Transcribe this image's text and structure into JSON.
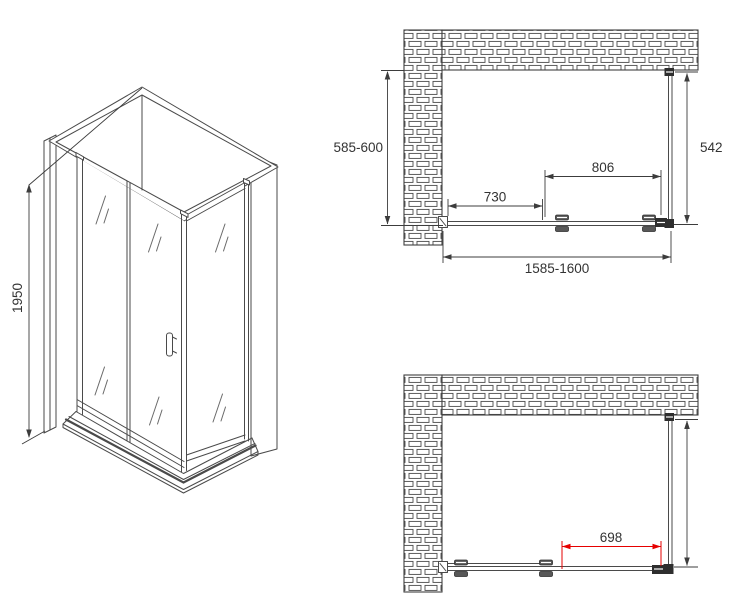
{
  "drawing": {
    "type": "shower-enclosure-technical-drawing",
    "labels": {
      "height": "1950",
      "depth_range": "585-600",
      "side_panel_depth": "542",
      "door_section_width": "806",
      "fixed_section_width": "730",
      "total_width_range": "1585-1600",
      "opening_width": "698"
    },
    "colors": {
      "line": "#4a4a4a",
      "dimension": "#3c3c3c",
      "dimension_red": "#e60000",
      "background": "#ffffff"
    }
  }
}
